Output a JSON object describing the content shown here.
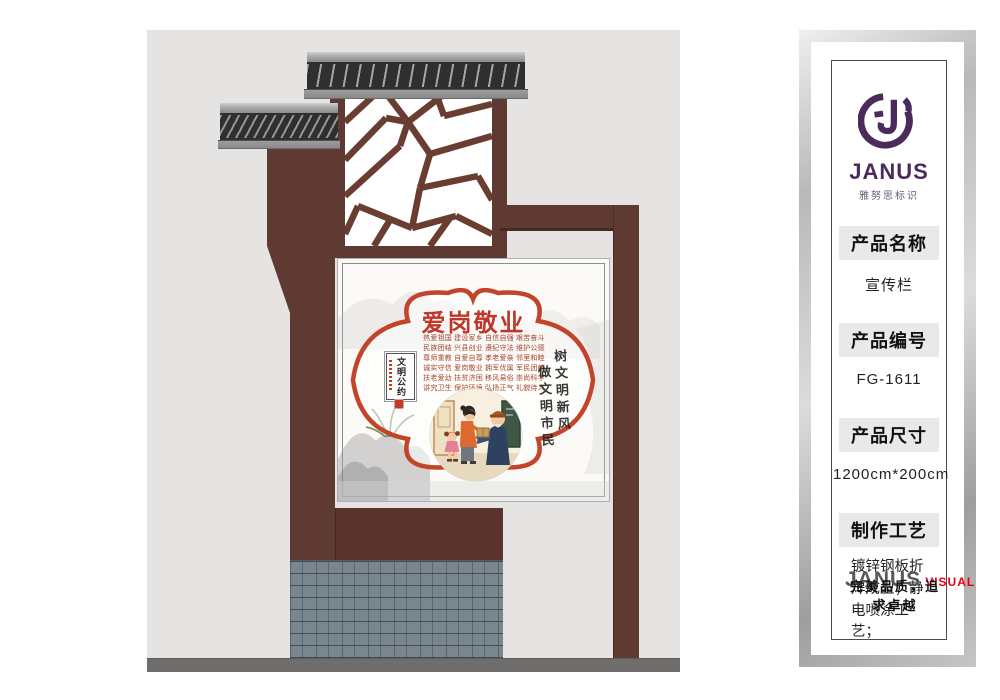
{
  "sidebar": {
    "logo": {
      "text": "JANUS",
      "subtext": "雅努思标识"
    },
    "fields": [
      {
        "label": "产品名称",
        "value": "宣传栏"
      },
      {
        "label": "产品编号",
        "value": "FG-1611"
      },
      {
        "label": "产品尺寸",
        "value": "1200cm*200cm"
      },
      {
        "label": "制作工艺",
        "value": "镀锌钢板折焊成型；静电喷涂工艺；"
      }
    ],
    "footer": {
      "brand": "JANUS",
      "brand_suffix": "VISUAL",
      "slogan": "完美品质，追求卓越"
    }
  },
  "sign": {
    "title": "爱岗敬业",
    "convention_rows": [
      "热爱祖国 建设家乡 自信自强 艰苦奋斗",
      "民族团结 兴县创业 遵纪守法 维护公德",
      "尊师重教 自爱自尊 孝老爱亲 邻里和睦",
      "诚实守信 爱岗敬业 拥军优属 军民团结",
      "扶老爱幼 扶贫济困 移风易俗 崇尚科学",
      "讲究卫生 保护环境 弘扬正气 礼貌待人"
    ],
    "seal_box_text": "文明公约",
    "calligraphy_right": "树文明新风",
    "calligraphy_left": "做文明市民"
  },
  "colors": {
    "brand_purple": "#4A2B5C",
    "visual_red": "#E60012",
    "sign_red": "#C2422A",
    "structure_maroon": "#5E3A33"
  }
}
